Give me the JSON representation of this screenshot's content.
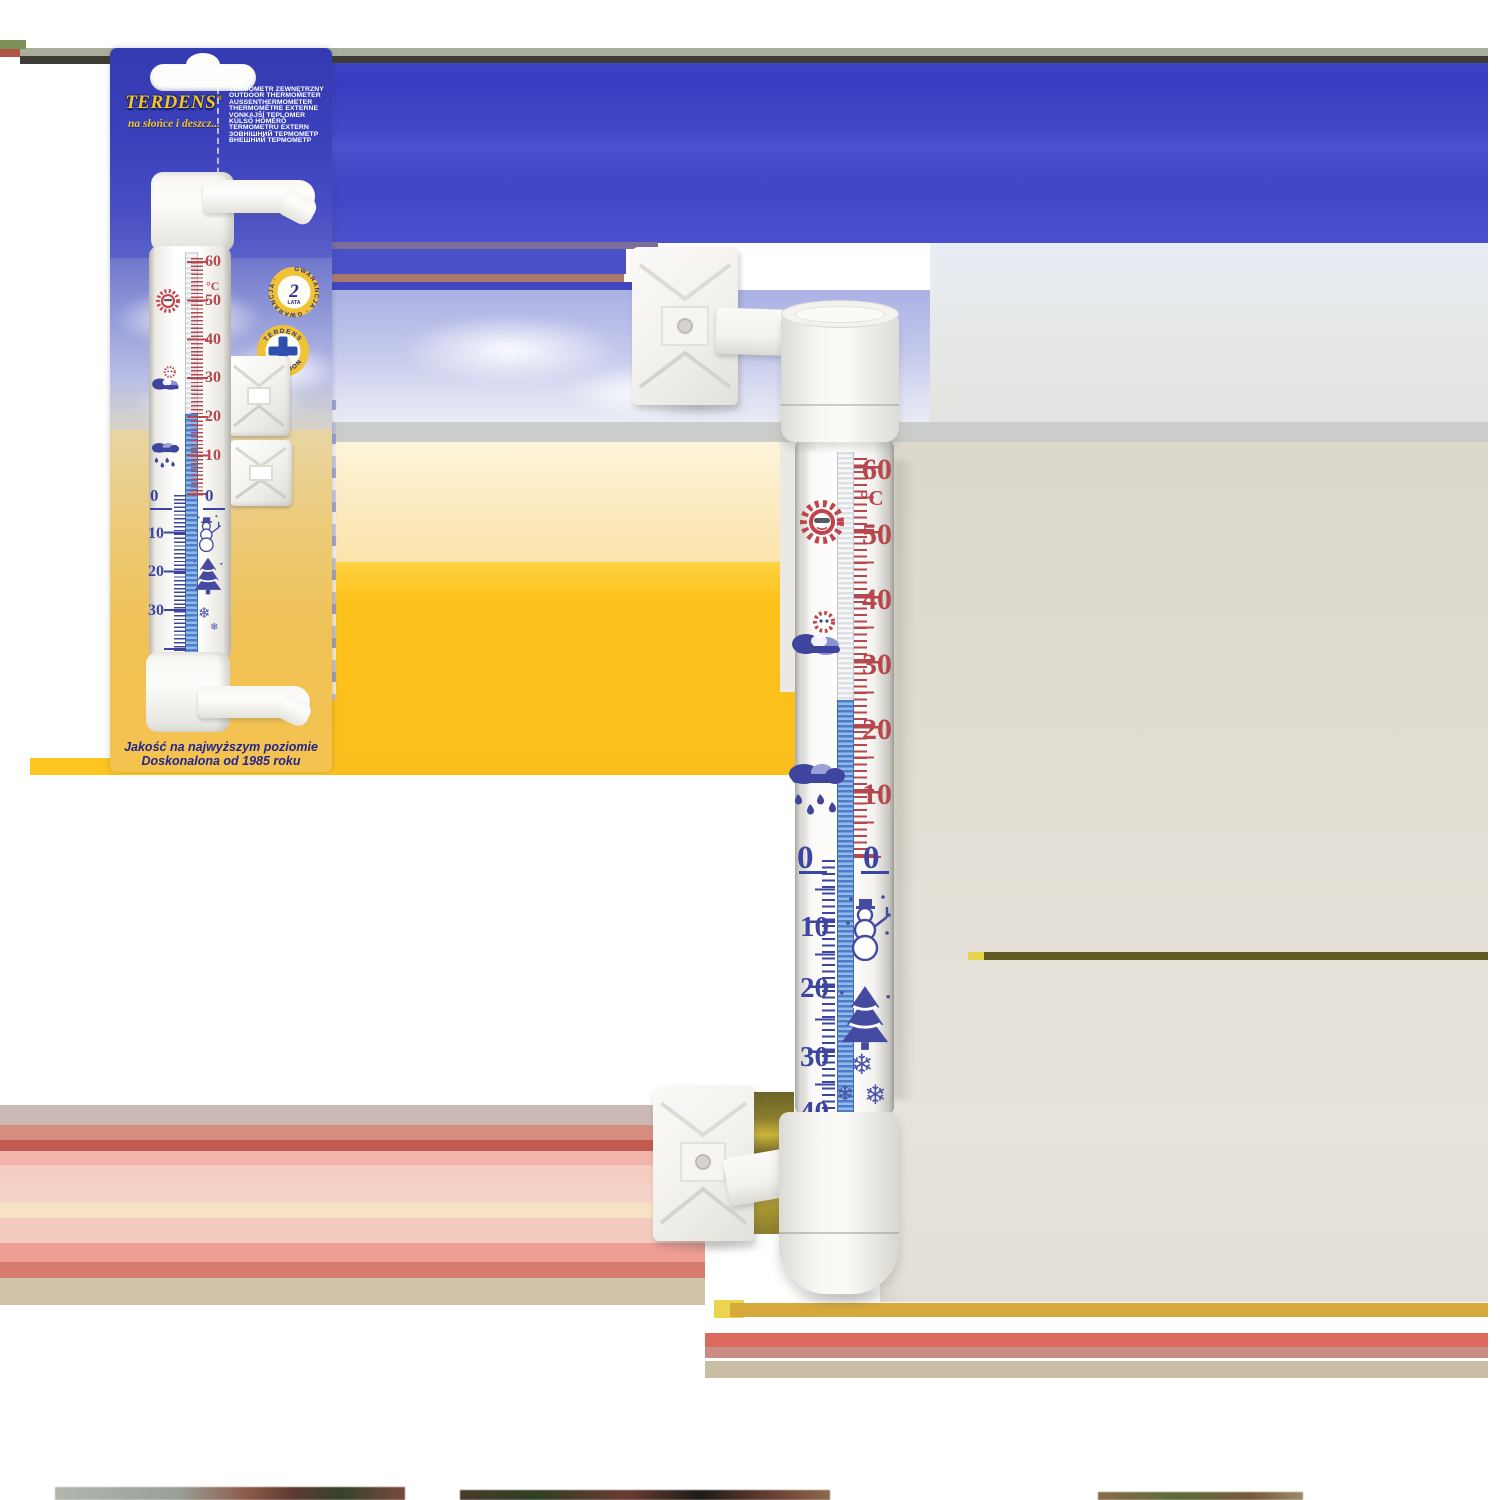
{
  "page": {
    "description": "Product photo: Terdens outdoor window thermometer, blister packaging on the left and enlarged thermometer with window mounting brackets on the right",
    "background": "#ffffff"
  },
  "brand": {
    "name": "TERDENS",
    "registered": "®",
    "tagline": "na słońce i deszcz..."
  },
  "product_names": [
    "TERMOMETR ZEWNĘTRZNY",
    "OUTDOOR THERMOMETER",
    "AUSSENTHERMOMETER",
    "THERMOMÈTRE EXTERNE",
    "VONKAJŠÍ TEPLOMER",
    "KÜLSŐ HŐMÉRŐ",
    "TERMOMETRU EXTERN",
    "ЗОВНІШНИЙ ТЕРМОМЕТР",
    "ВНЕШНИЙ ТЕРМОМЕТР"
  ],
  "badges": {
    "warranty": {
      "ring_text": "GWARANCJA · GWARANCJA ·",
      "years": "2",
      "years_label": "LATA"
    },
    "precision": {
      "top": "TERDENS",
      "bottom": "PRECISION"
    }
  },
  "quality_text": {
    "line1": "Jakość na najwyższym poziomie",
    "line2": "Doskonalona od 1985 roku"
  },
  "scale": {
    "unit": "°C",
    "min_c": -40,
    "max_c": 60,
    "p60": "60",
    "p50": "50",
    "p40": "40",
    "p30": "30",
    "p20": "20",
    "p10": "10",
    "zero": "0",
    "n10": "10",
    "n20": "20",
    "n30": "30",
    "n40": "40",
    "reading_large_c": 24,
    "reading_packaged_c": 22,
    "icons": [
      {
        "name": "sun-icon",
        "approx_c": 52,
        "color": "#c0444b"
      },
      {
        "name": "sun-behind-cloud-icon",
        "approx_c": 34,
        "color": "#3f459e"
      },
      {
        "name": "rain-cloud-icon",
        "approx_c": 12,
        "color": "#3f459e"
      },
      {
        "name": "snowman-icon",
        "approx_c": -12,
        "color": "#454ba0"
      },
      {
        "name": "christmas-tree-icon",
        "approx_c": -22,
        "color": "#454ba0"
      },
      {
        "name": "snowflakes-icon",
        "approx_c": -31,
        "color": "#4a55a8"
      }
    ]
  },
  "snowflake_glyph": "❄",
  "colors": {
    "brand_blue": "#3b42c6",
    "brand_yellow": "#f6c61e",
    "scale_red": "#b5474d",
    "scale_blue": "#3c45a0",
    "liquid_blue": "#4c7dc6",
    "card_sand": "#f2c14e",
    "background_amber": "#fcc21c",
    "background_beige": "#ded9cd"
  }
}
